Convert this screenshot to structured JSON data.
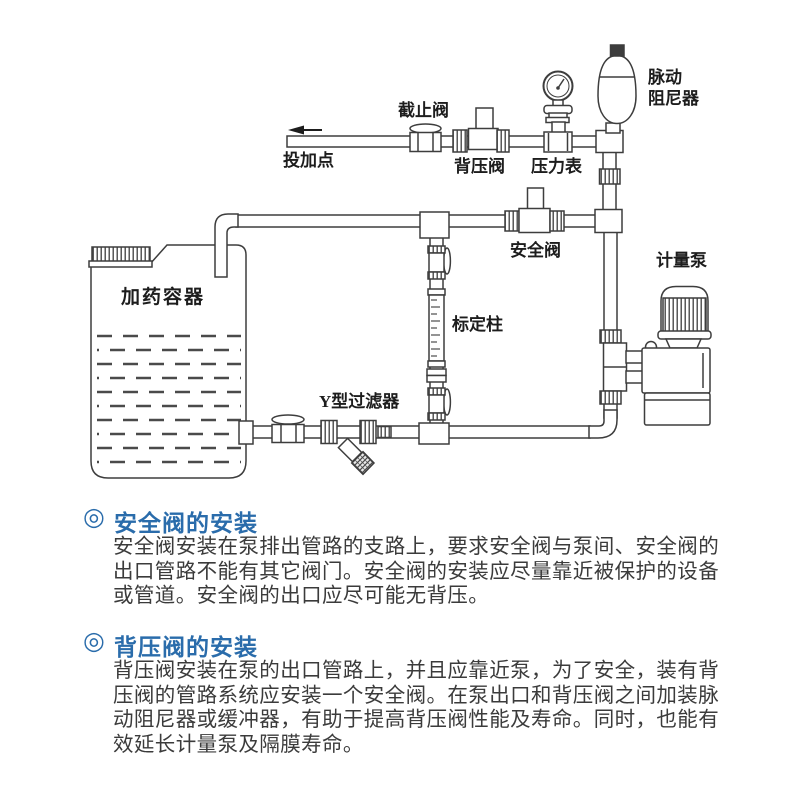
{
  "diagram": {
    "labels": {
      "dosing_point": "投加点",
      "stop_valve": "截止阀",
      "back_pressure_valve": "背压阀",
      "pressure_gauge": "压力表",
      "pulse_damper_line1": "脉动",
      "pulse_damper_line2": "阻尼器",
      "safety_valve": "安全阀",
      "metering_pump": "计量泵",
      "dosing_tank": "加药容器",
      "calibration_column": "标定柱",
      "y_strainer": "Y型过滤器"
    }
  },
  "sections": [
    {
      "bullet": "◎",
      "title": "安全阀的安装",
      "lines": [
        "安全阀安装在泵排出管路的支路上，要求安全阀与泵间、安全阀的",
        "出口管路不能有其它阀门。安全阀的安装应尽量靠近被保护的设备",
        "或管道。安全阀的出口应尽可能无背压。"
      ]
    },
    {
      "bullet": "◎",
      "title": "背压阀的安装",
      "lines": [
        "背压阀安装在泵的出口管路上，并且应靠近泵，为了安全，装有背",
        "压阀的管路系统应安装一个安全阀。在泵出口和背压阀之间加装脉",
        "动阻尼器或缓冲器，有助于提高背压阀性能及寿命。同时，也能有",
        "效延长计量泵及隔膜寿命。"
      ]
    }
  ],
  "colors": {
    "heading_blue": "#2a6cab",
    "body_text": "#3b3b3b",
    "line_art": "#3d3d3d"
  }
}
